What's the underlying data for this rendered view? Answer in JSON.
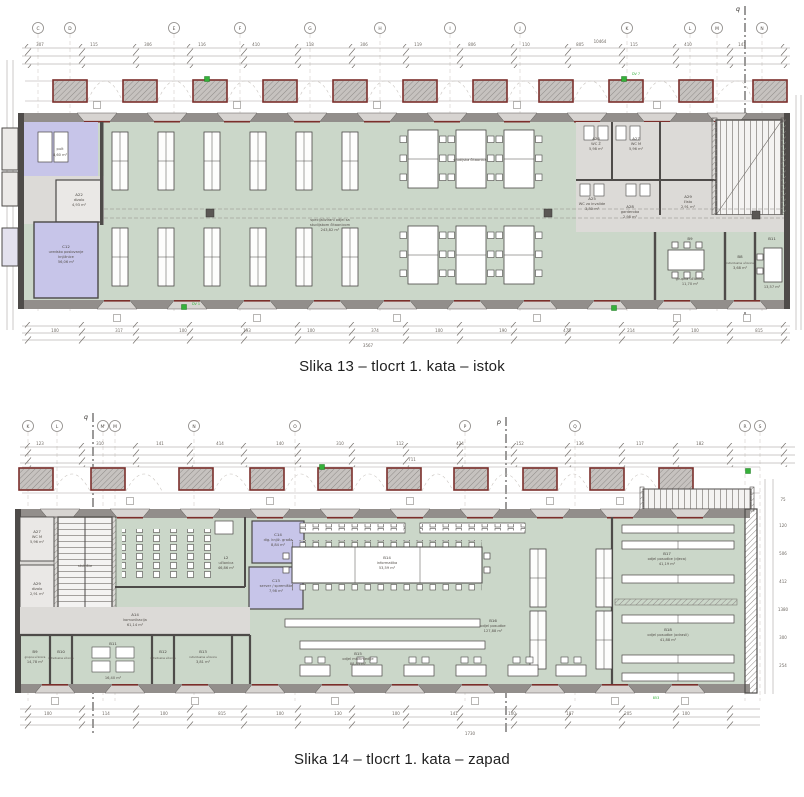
{
  "colors": {
    "room_green": "#cbd7c9",
    "room_purple": "#c7c5e9",
    "zone_gray": "#dcdad7",
    "wall_dark": "#4e4b49",
    "wall_band": "#928e8b",
    "accent_maroon": "#7b2e2b",
    "marker_green": "#2fae35"
  },
  "figure1": {
    "caption": "Slika 13 – tlocrt 1. kata – istok",
    "grid_letters": [
      "C",
      "D",
      "E",
      "F",
      "G",
      "H",
      "I",
      "J",
      "K",
      "L",
      "M",
      "N"
    ],
    "section_marker": "q",
    "marker_note": "DV 7",
    "marker_note2": "DV 1",
    "dims_total_top": "10464",
    "dims_top": [
      "307",
      "115",
      "306",
      "116",
      "410",
      "118",
      "306",
      "119",
      "806",
      "110",
      "805",
      "115",
      "410",
      "141"
    ],
    "dims_bottom": [
      "100",
      "317",
      "100",
      "193",
      "100",
      "374",
      "100",
      "190",
      "475",
      "214",
      "100",
      "815"
    ],
    "dims_total_bottom": "3567",
    "rooms": {
      "pult": {
        "name": "pult",
        "area": "8,60 m²"
      },
      "a22": {
        "code": "A22",
        "name": "dizalo",
        "area": "4,93 m²"
      },
      "c12": {
        "code": "C12",
        "name1": "uredsko poslovanje",
        "name2": "knjižnice",
        "area": "56,06 m²"
      },
      "hall": {
        "name1": "specijalizirani odjel sa",
        "name2": "studijskom čitaonicom",
        "area": "243,82 m²"
      },
      "citaonica": {
        "name": "studijska čitaonica"
      },
      "a26": {
        "code": "A26",
        "name": "WC Ž",
        "area": "5,98 m²"
      },
      "a27": {
        "code": "A27",
        "name": "WC M",
        "area": "5,96 m²"
      },
      "a25": {
        "code": "A25",
        "name": "WC za invalide",
        "area": "3,80 m²"
      },
      "a28": {
        "code": "A28",
        "name": "garderoba",
        "area": "2,98 m²"
      },
      "a29": {
        "code": "A29",
        "name": "čisto",
        "area": "2,91 m²"
      },
      "b9": {
        "code": "B9",
        "name": "grupna učionica",
        "area": "11,70 m²"
      },
      "b8": {
        "code": "B8",
        "name": "individualna učionica",
        "area": "3,68 m²"
      },
      "b11": {
        "code": "B11",
        "name": "grupna učionica",
        "area": "13,57 m²"
      }
    }
  },
  "figure2": {
    "caption": "Slika 14 – tlocrt 1. kata – zapad",
    "grid_letters": [
      "K",
      "L",
      "M'",
      "M",
      "N",
      "O",
      "P",
      "Q",
      "R",
      "S"
    ],
    "section_marker_q": "q",
    "section_marker_p": "p",
    "marker_note": "853",
    "dims_total_top": "711",
    "dims_top": [
      "123",
      "310",
      "141",
      "414",
      "140",
      "310",
      "112",
      "424",
      "152",
      "136",
      "117",
      "182"
    ],
    "dims_bottom": [
      "100",
      "114",
      "100",
      "815",
      "100",
      "130",
      "100",
      "141",
      "100",
      "187",
      "205",
      "100"
    ],
    "dims_total_bottom": "1730",
    "dims_right": [
      "75",
      "120",
      "506",
      "412",
      "1380",
      "300",
      "254"
    ],
    "rooms": {
      "a27": {
        "code": "A27",
        "name": "WC M",
        "area": "5,96 m²"
      },
      "a29": {
        "code": "A29",
        "name": "dizalo",
        "area": "2,91 m²"
      },
      "stair": {
        "name": "stubište"
      },
      "l2": {
        "code": "L2",
        "name": "učionica",
        "area": "46,86 m²"
      },
      "c14": {
        "code": "C14",
        "name": "dig. knjiž. građa",
        "area": "8,84 m²"
      },
      "c13": {
        "code": "C13",
        "name": "server / spremište",
        "area": "7,98 m²"
      },
      "b14": {
        "code": "B14",
        "name": "informatika",
        "area": "53,59 m²"
      },
      "b15": {
        "code": "B15",
        "name": "odjel multimedije",
        "area": "88,85 m²"
      },
      "b16": {
        "code": "B16",
        "name": "odjel posudbe",
        "area": "127,88 m²"
      },
      "b17": {
        "code": "B17",
        "name": "odjel posudbe (djeca)",
        "area": "41,19 m²"
      },
      "b18": {
        "code": "B18",
        "name": "odjel posudbe (odrasli)",
        "area": "41,88 m²"
      },
      "a14": {
        "code": "A14",
        "name": "komunikacija",
        "area": "61,14 m²"
      },
      "b9": {
        "code": "B9",
        "name": "grupna učionica",
        "area": "14,78 m²"
      },
      "b10": {
        "code": "B10",
        "name": "individualna učionica",
        "area": "3,68 m²"
      },
      "b11": {
        "code": "B11",
        "name": "grupna učionica",
        "area": "16,40 m²"
      },
      "b12": {
        "code": "B12",
        "name": "individualna učionica",
        "area": "3,66 m²"
      },
      "b13": {
        "code": "B13",
        "name": "individualna učionica",
        "area": "3,81 m²"
      }
    }
  }
}
